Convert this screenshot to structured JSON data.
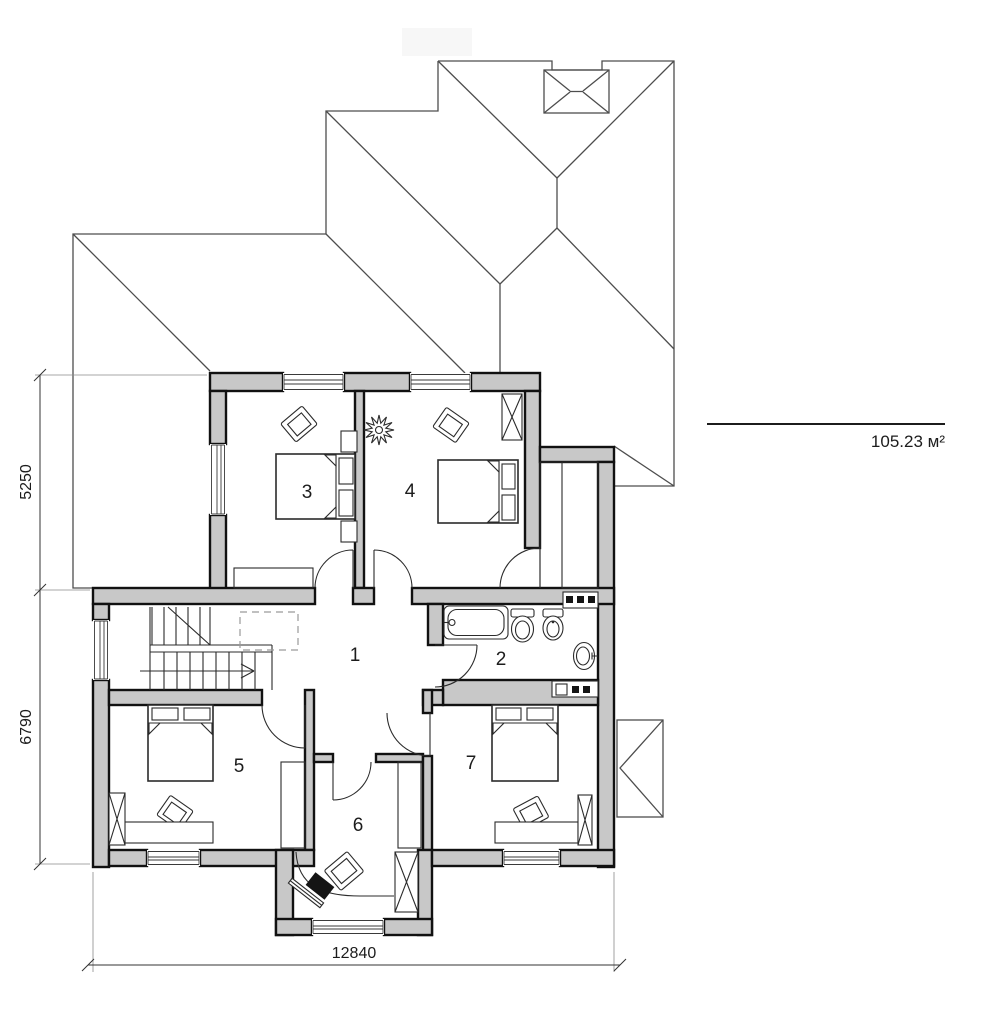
{
  "plan": {
    "title": "second-floor plan",
    "room_labels": [
      "1",
      "2",
      "3",
      "4",
      "5",
      "6",
      "7"
    ],
    "dimensions": {
      "left_upper": "5250",
      "left_lower": "6790",
      "bottom": "12840"
    },
    "area_label": "105.23 м²",
    "colors": {
      "wall_fill": "#c8c8c8",
      "wall_stroke": "#111111",
      "roof_line": "#4d4d4d",
      "furniture_line": "#2b2b2b",
      "dim_line": "#333333"
    }
  }
}
